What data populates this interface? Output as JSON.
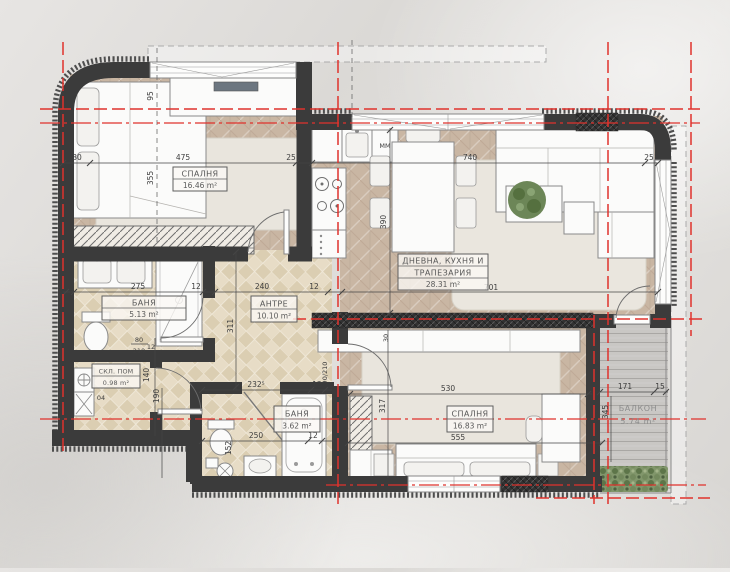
{
  "title": "Apartment floor plan",
  "colors": {
    "axis_red": "#e0322c",
    "wall": "#3b3b3b",
    "floor_wood": "#c9b6a3",
    "floor_tile": "#e3d7c0",
    "balcony_deck": "#c9c7c4",
    "greenery": "#81966b"
  },
  "rooms": {
    "bedroom1": {
      "name": "СПАЛНЯ",
      "area": "16.46 m²"
    },
    "living": {
      "name_line1": "ДНЕВНА, КУХНЯ И",
      "name_line2": "ТРАПЕЗАРИЯ",
      "area": "28.31 m²"
    },
    "bath1": {
      "name": "БАНЯ",
      "area": "5.13 m²"
    },
    "hall": {
      "name": "АНТРЕ",
      "area": "10.10 m²"
    },
    "storage": {
      "name": "СКЛ. ПОМ",
      "area": "0.98 m²",
      "number": "04"
    },
    "bath2": {
      "name": "БАНЯ",
      "area": "3.62 m²"
    },
    "bedroom2": {
      "name": "СПАЛНЯ",
      "area": "16.83 m²"
    },
    "balcony": {
      "name": "БАЛКОН",
      "area": "5.74 m²"
    }
  },
  "appliances": {
    "washing_machine": "MM"
  },
  "dimensions": {
    "top_30": "30",
    "top_475": "475",
    "top_25a": "25",
    "top_740": "740",
    "top_25b": "25",
    "v_95": "95",
    "v_355": "355",
    "v_390": "390",
    "mid_275": "275",
    "mid_12a": "12",
    "mid_240": "240",
    "mid_12b": "12",
    "mid_701": "701",
    "v_311": "311",
    "v_140": "140",
    "v_190": "190",
    "v_12": "12",
    "door_w": "80",
    "door_h": "210",
    "door2": "90/210",
    "bath2_232": "232⁵",
    "bath2_12a": "12",
    "bath2_250": "250",
    "bath2_12b": "12",
    "v_152": "152",
    "bed2_530": "530",
    "bed2_555": "555",
    "v_317": "317",
    "v_30": "30",
    "balc_171": "171",
    "balc_15": "15",
    "v_345": "345"
  }
}
